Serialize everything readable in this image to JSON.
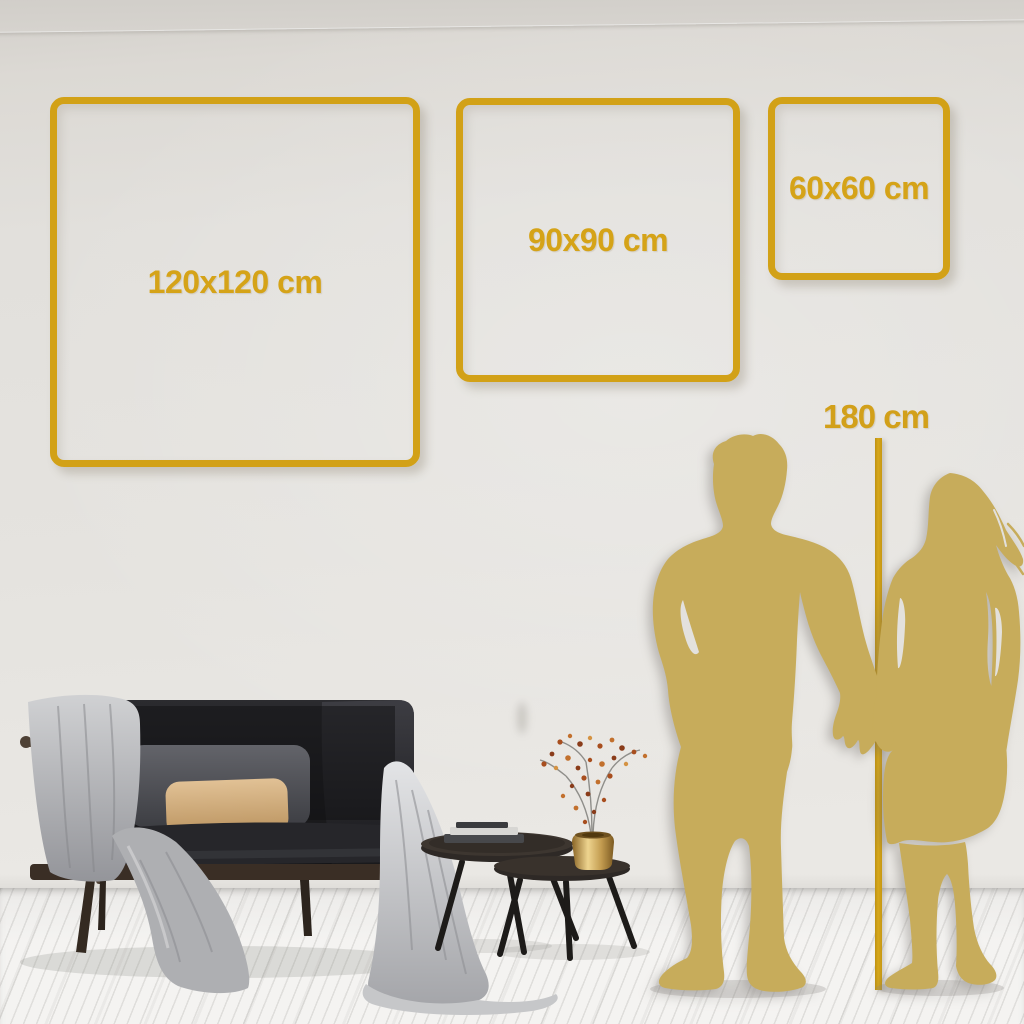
{
  "size_guide": {
    "frames": [
      {
        "label": "120x120 cm",
        "width_cm": 120,
        "height_cm": 120
      },
      {
        "label": "90x90 cm",
        "width_cm": 90,
        "height_cm": 90
      },
      {
        "label": "60x60 cm",
        "width_cm": 60,
        "height_cm": 60
      }
    ],
    "person_height": {
      "label": "180 cm",
      "height_cm": 180
    }
  },
  "colors": {
    "accent_gold": "#D2A117",
    "silhouette_gold": "#C7AC5B",
    "wall": "#E4E2DE",
    "floor": "#F2F1EF"
  },
  "illustrations": {
    "couple": "man-and-woman-holding-hands-silhouette",
    "sofa": "dark-loveseat-with-gray-throw-blanket",
    "tables": "nesting-coffee-tables-with-books-and-brass-vase"
  }
}
